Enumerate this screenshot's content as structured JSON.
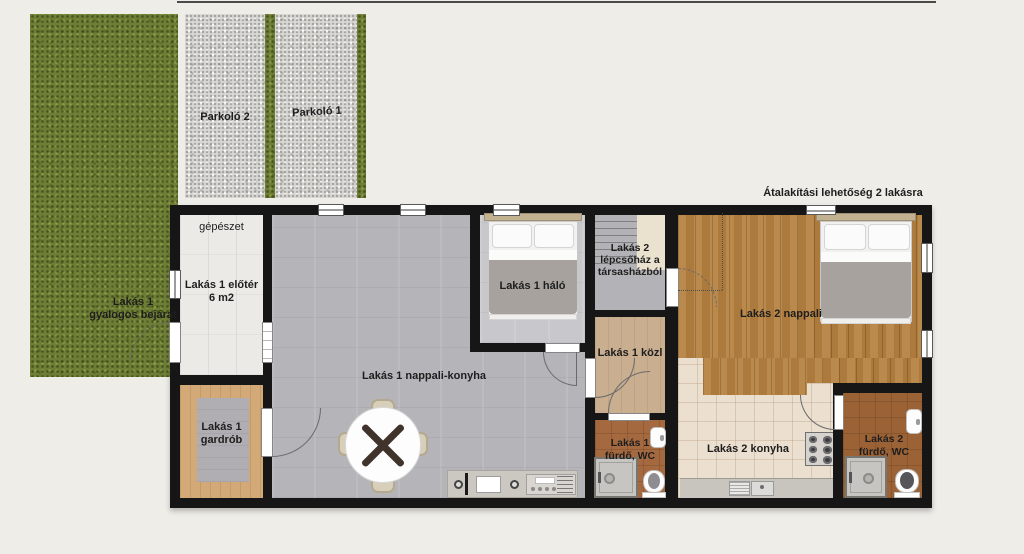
{
  "title": "Átalakítási lehetőség 2 lakásra",
  "parking": {
    "spot_left": "Parkoló 2",
    "spot_right": "Parkoló 1"
  },
  "rooms": {
    "gepeszet": "gépészet",
    "eloter": "Lakás 1 előtér\n6 m2",
    "bejarat": "Lakás 1\ngyalogos bejárat",
    "halo1": "Lakás 1 háló",
    "lepcsohaz2": "Lakás 2\nlépcsőház a\ntársasházból",
    "nappali_konyha1": "Lakás 1 nappali-konyha",
    "kozl1": "Lakás 1 közl",
    "nappali2": "Lakás 2 nappali",
    "gardrob1": "Lakás 1\ngardrób",
    "furdo1": "Lakás 1\nfürdő, WC",
    "konyha2": "Lakás 2 konyha",
    "furdo2": "Lakás 2\nfürdő, WC"
  },
  "palette": {
    "background": "#efede8",
    "grass": "#6f7e36",
    "gravel": "#d9d8d4",
    "wall": "#161616",
    "wood_nappali2": "#b5803f",
    "wood_gardrob": "#d2a977",
    "wood_kozl": "#c9ae90",
    "tile_gray": "#b5b4b9",
    "tile_halo": "#c8c7cb",
    "tile_konyha2": "#ebdfd0",
    "tile_furdo": "#a5693f",
    "blanket": "#a7a29e"
  }
}
